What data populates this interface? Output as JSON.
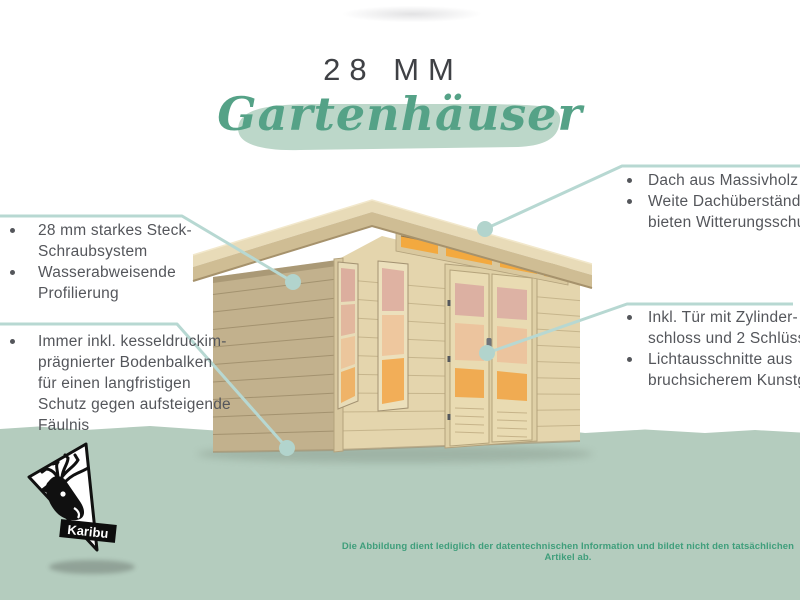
{
  "header": {
    "size_label": "28 MM",
    "product_label": "Gartenhäuser"
  },
  "features_left": [
    {
      "items": [
        {
          "lines": [
            "28 mm starkes Steck-",
            "Schraubsystem"
          ]
        },
        {
          "lines": [
            "Wasserabweisende",
            "Profilierung"
          ]
        }
      ]
    },
    {
      "items": [
        {
          "lines": [
            "Immer inkl. kesseldruckim-",
            "prägnierter Bodenbalken",
            "für einen langfristigen",
            "Schutz gegen aufsteigende",
            "Fäulnis"
          ]
        }
      ]
    }
  ],
  "features_right": [
    {
      "items": [
        {
          "lines": [
            "Dach aus Massivholz"
          ]
        },
        {
          "lines": [
            "Weite Dachüberstände",
            "bieten Witterungsschutz"
          ]
        }
      ]
    },
    {
      "items": [
        {
          "lines": [
            "Inkl. Tür mit Zylinder-",
            "schloss und 2 Schlüsseln"
          ]
        },
        {
          "lines": [
            "Lichtausschnitte aus",
            "bruchsicherem Kunstglas"
          ]
        }
      ]
    }
  ],
  "brand": {
    "name": "Karibu"
  },
  "disclaimer": "Die Abbildung dient lediglich der datentechnischen Information und bildet nicht den tatsächlichen Artikel ab.",
  "colors": {
    "accent_green": "#55a287",
    "mint_band": "#b4ccbe",
    "brush_stroke": "#bcd7c9",
    "pointer_teal": "#b7d8d2",
    "body_text": "#54565b",
    "title_text": "#3f4145",
    "disclaimer_green": "#3f9e7b",
    "wood_front": "#e4d5ad",
    "wood_side": "#c2b18d",
    "roof_wood": "#cfbd94",
    "glass_orange": "#f2ad56"
  }
}
